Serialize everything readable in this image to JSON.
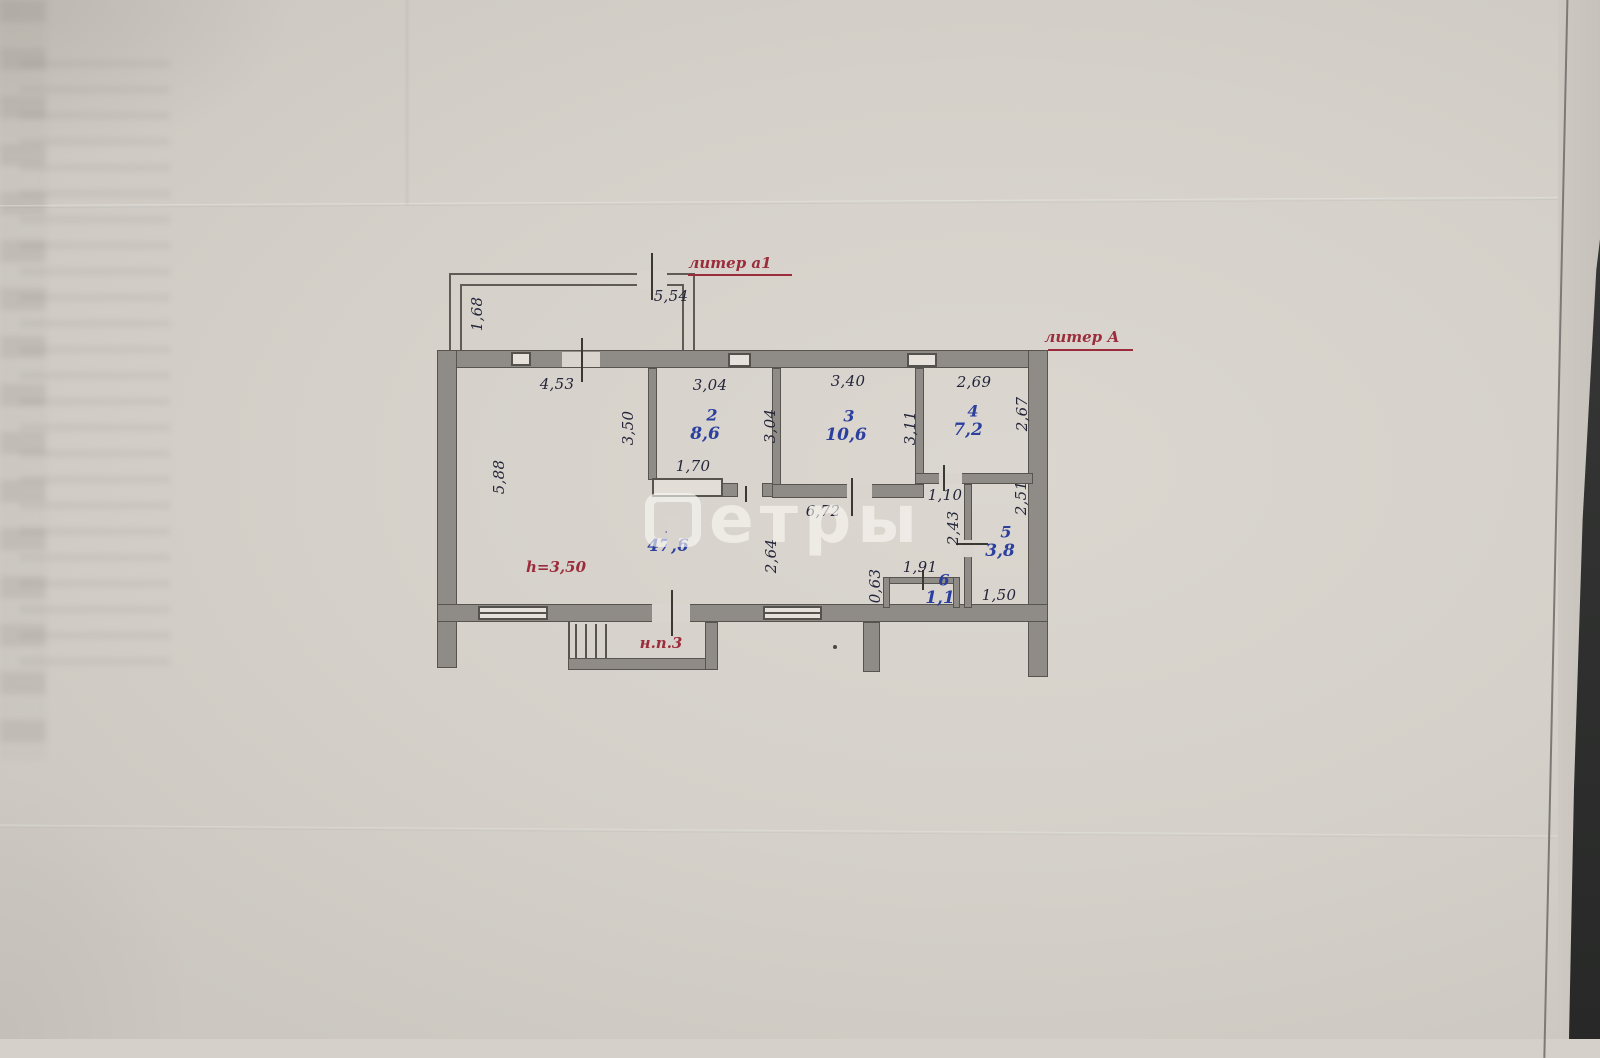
{
  "watermark": {
    "text": "етры",
    "logo": "metry-watermark-logo"
  },
  "red_labels": [
    {
      "name": "label-liter-a1",
      "text": "литер а1",
      "x": 730,
      "y": 263,
      "ux1": 688,
      "ux2": 792,
      "uy": 274
    },
    {
      "name": "label-liter-A",
      "text": "литер А",
      "x": 1082,
      "y": 337,
      "ux1": 1048,
      "ux2": 1133,
      "uy": 349
    },
    {
      "name": "label-ceiling-height",
      "text": "h=3,50",
      "x": 556,
      "y": 567
    },
    {
      "name": "label-np3",
      "text": "н.п.3",
      "x": 661,
      "y": 643
    }
  ],
  "rooms": [
    {
      "name": "room-1",
      "number": "1",
      "area": "47,6",
      "nx": 670,
      "ny": 527,
      "ax": 668,
      "ay": 546
    },
    {
      "name": "room-2",
      "number": "2",
      "area": "8,6",
      "nx": 712,
      "ny": 415,
      "ax": 705,
      "ay": 434
    },
    {
      "name": "room-3",
      "number": "3",
      "area": "10,6",
      "nx": 849,
      "ny": 416,
      "ax": 846,
      "ay": 435
    },
    {
      "name": "room-4",
      "number": "4",
      "area": "7,2",
      "nx": 973,
      "ny": 411,
      "ax": 968,
      "ay": 430
    },
    {
      "name": "room-5",
      "number": "5",
      "area": "3,8",
      "nx": 1006,
      "ny": 532,
      "ax": 1000,
      "ay": 551
    },
    {
      "name": "room-6",
      "number": "6",
      "area": "1,1",
      "nx": 944,
      "ny": 580,
      "ax": 940,
      "ay": 598
    }
  ],
  "dimensions": [
    {
      "text": "5,54",
      "x": 671,
      "y": 296,
      "v": false
    },
    {
      "text": "1,68",
      "x": 477,
      "y": 314,
      "v": true
    },
    {
      "text": "4,53",
      "x": 557,
      "y": 384,
      "v": false
    },
    {
      "text": "3,04",
      "x": 710,
      "y": 385,
      "v": false
    },
    {
      "text": "3,40",
      "x": 848,
      "y": 381,
      "v": false
    },
    {
      "text": "2,69",
      "x": 974,
      "y": 382,
      "v": false
    },
    {
      "text": "3,50",
      "x": 628,
      "y": 428,
      "v": true
    },
    {
      "text": "3,04",
      "x": 770,
      "y": 426,
      "v": true
    },
    {
      "text": "3,11",
      "x": 910,
      "y": 428,
      "v": true
    },
    {
      "text": "2,67",
      "x": 1022,
      "y": 414,
      "v": true
    },
    {
      "text": "5,88",
      "x": 499,
      "y": 477,
      "v": true
    },
    {
      "text": "1,70",
      "x": 693,
      "y": 466,
      "v": false
    },
    {
      "text": "6,72",
      "x": 823,
      "y": 511,
      "v": false
    },
    {
      "text": "1,10",
      "x": 945,
      "y": 495,
      "v": false
    },
    {
      "text": "2,51",
      "x": 1021,
      "y": 498,
      "v": true
    },
    {
      "text": "2,43",
      "x": 953,
      "y": 528,
      "v": true
    },
    {
      "text": "2,64",
      "x": 771,
      "y": 556,
      "v": true
    },
    {
      "text": "1,91",
      "x": 920,
      "y": 567,
      "v": false
    },
    {
      "text": "0,63",
      "x": 875,
      "y": 586,
      "v": true
    },
    {
      "text": "1,50",
      "x": 999,
      "y": 595,
      "v": false
    }
  ]
}
